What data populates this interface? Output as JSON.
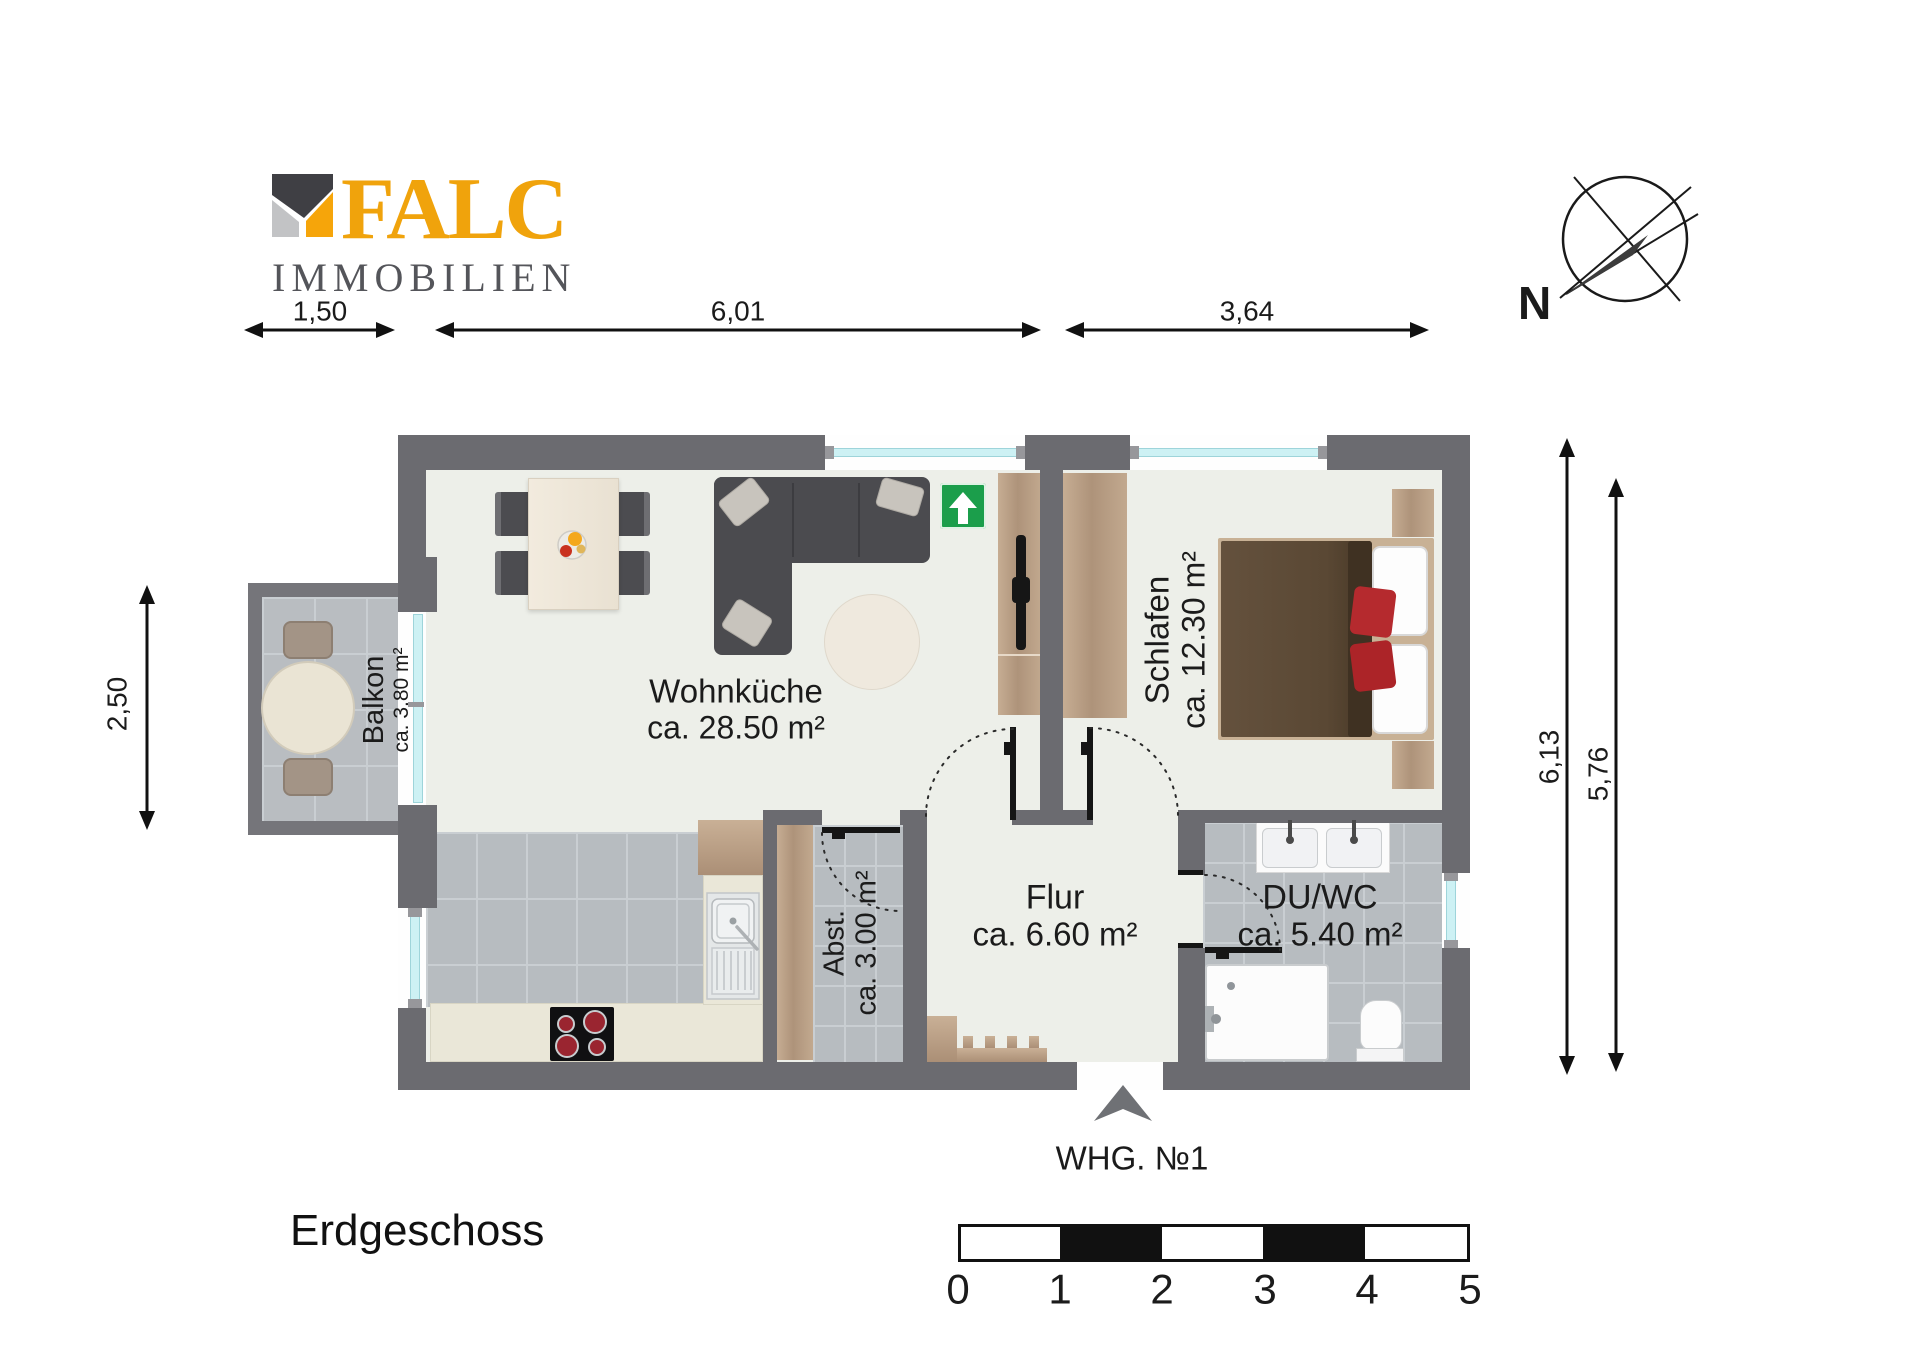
{
  "branding": {
    "name": "FALC",
    "tagline": "IMMOBILIEN",
    "brand_color": "#F0A30C",
    "tagline_color": "#54555A"
  },
  "plan": {
    "floor_label": "Erdgeschoss",
    "unit_label": "WHG. №1",
    "compass_north": "N",
    "rooms": {
      "wohnkueche": {
        "name": "Wohnküche",
        "area": "ca. 28.50 m²"
      },
      "schlafen": {
        "name": "Schlafen",
        "area": "ca. 12.30 m²"
      },
      "balkon": {
        "name": "Balkon",
        "area": "ca. 3.80 m²"
      },
      "abstellraum": {
        "name": "Abst.",
        "area": "ca. 3.00 m²"
      },
      "flur": {
        "name": "Flur",
        "area": "ca. 6.60 m²"
      },
      "duschwc": {
        "name": "DU/WC",
        "area": "ca. 5.40 m²"
      }
    },
    "dimensions": {
      "top_balcony_width": "1,50",
      "top_living_width": "6,01",
      "top_bedroom_width": "3,64",
      "left_balcony_depth": "2,50",
      "right_outer_depth": "6,13",
      "right_inner_depth": "5,76"
    },
    "scale_bar": {
      "ticks": [
        "0",
        "1",
        "2",
        "3",
        "4",
        "5"
      ]
    }
  },
  "colors": {
    "wall": "#6B6B70",
    "floor": "#EDEFE9",
    "tile": "#B7BCC0",
    "window_glass": "#CDF1F4",
    "wood": "#B79E86",
    "exit_sign_green": "#1B9E4B",
    "bed_blanket_brown": "#5C4936",
    "bed_pillow_red": "#B52A2E",
    "cooktop_burner_red": "#9A2530"
  }
}
